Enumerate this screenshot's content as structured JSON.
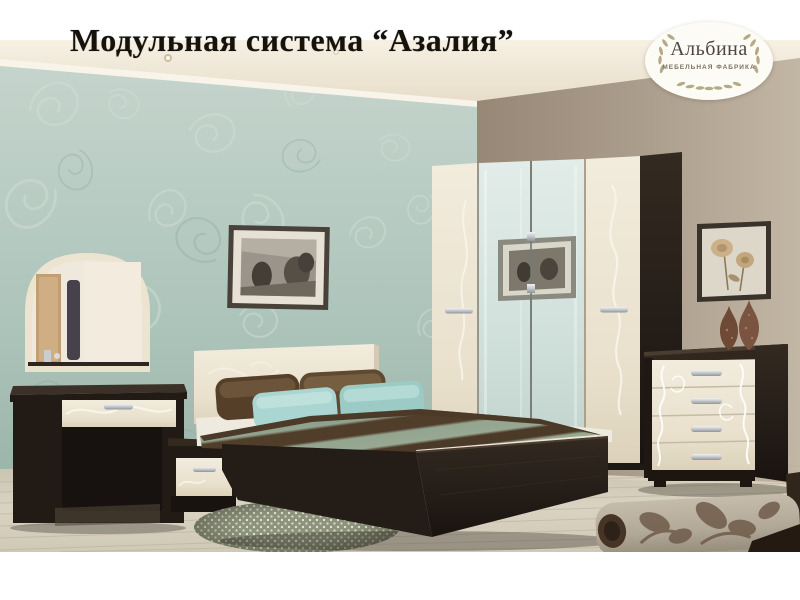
{
  "page": {
    "title": "Модульная система “Азалия”"
  },
  "logo": {
    "brand": "Альбина",
    "subtitle": "МЕБЕЛЬНАЯ ФАБРИКА",
    "icon": "laurel-wreath"
  },
  "palette": {
    "wall_left_teal": "#aec5bb",
    "wall_right_taupe": "#ab9d8b",
    "ceiling_cream": "#f0e9da",
    "floor_laminate": "#d5cebd",
    "wenge_dark_wood": "#261e17",
    "cream_gloss_fronts": "#ece4d2",
    "mirror_glass": "#d7e4e0",
    "pillow_teal": "#a7d3ce",
    "pillow_brown": "#5a452e",
    "blanket_sage": "#93a48f",
    "blanket_stripe_brown": "#4c3a28",
    "title_text": "#16120b",
    "logo_text": "#4e463d",
    "laurel": "#b3a67e"
  }
}
